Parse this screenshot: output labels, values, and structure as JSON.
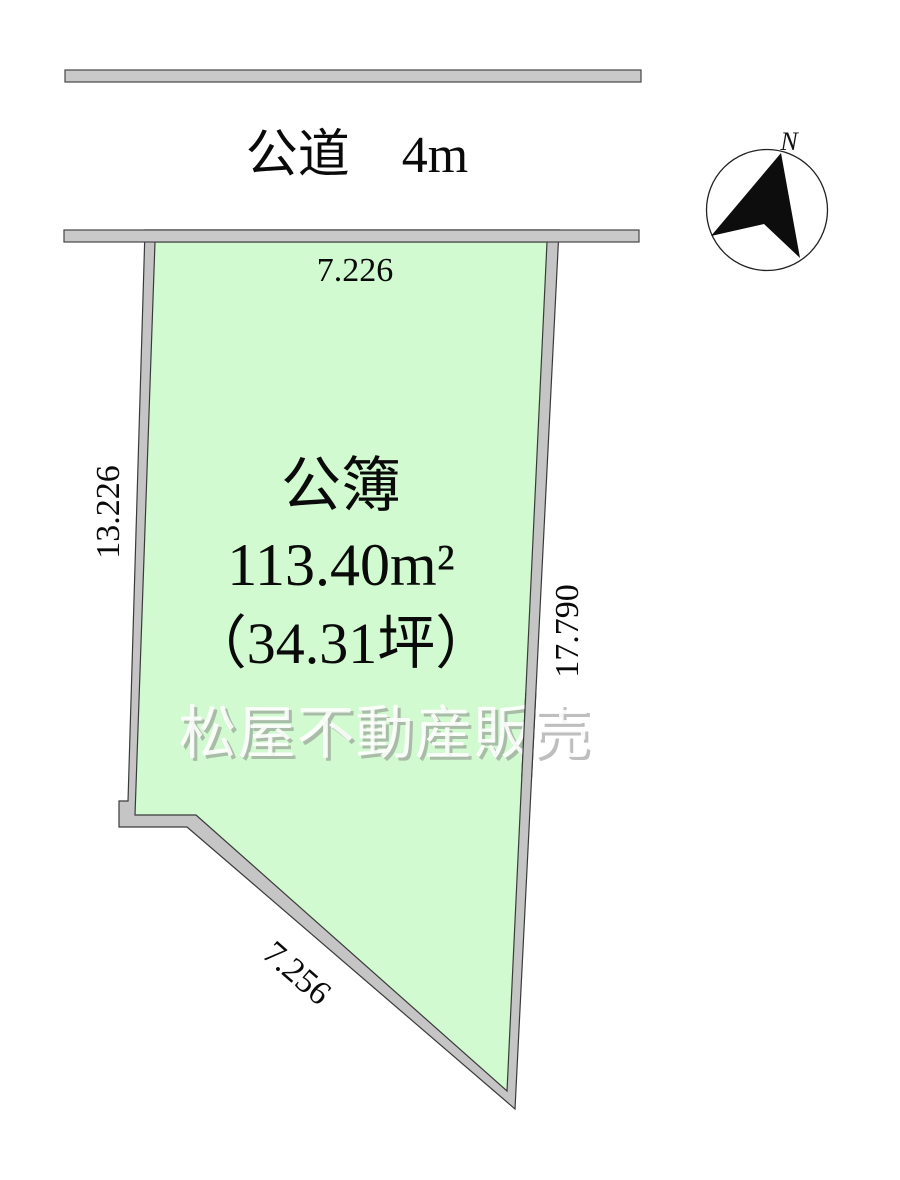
{
  "road": {
    "label": "公道　4m"
  },
  "parcel": {
    "title": "公簿",
    "area_m2": "113.40m²",
    "area_tsubo": "（34.31坪）",
    "dimensions": {
      "top": "7.226",
      "left": "13.226",
      "right": "17.790",
      "bottom": "7.256"
    }
  },
  "compass": {
    "north": "N"
  },
  "watermark": {
    "text": "松屋不動産販売"
  },
  "colors": {
    "parcel_fill": "#d2fad0",
    "border_fill": "#c5c5c5",
    "road_fill": "#c9c9c9",
    "outline": "#3a3a3a",
    "text": "#0a0a0a",
    "watermark_fill": "rgba(255,255,255,0.88)",
    "watermark_shadow": "rgba(125,125,125,0.5)"
  }
}
